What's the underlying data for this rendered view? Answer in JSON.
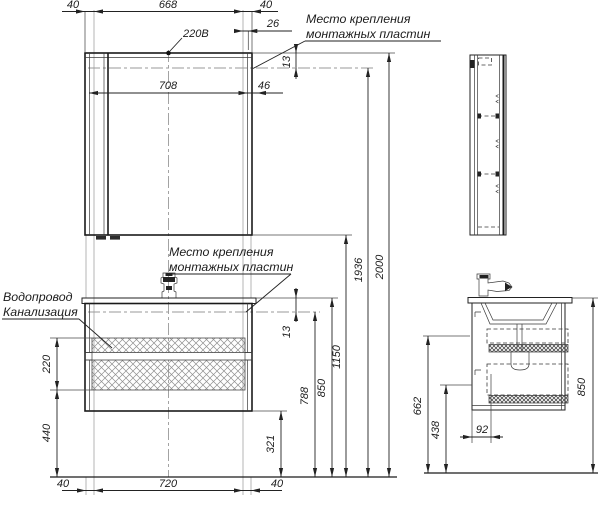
{
  "drawing": {
    "title_semantic": "bathroom-furniture-installation-drawing",
    "labels": {
      "power": "220В",
      "mount_top": [
        "Место крепления",
        "монтажных пластин"
      ],
      "mount_mid": [
        "Место крепления",
        "монтажных пластин"
      ],
      "water": "Водопровод",
      "sewer": "Канализация"
    },
    "dims": {
      "top_40_left": "40",
      "top_668": "668",
      "top_40_right": "40",
      "top_26": "26",
      "mirror_708": "708",
      "mirror_46": "46",
      "gap_13_top": "13",
      "gap_13_mid": "13",
      "h_220": "220",
      "h_440": "440",
      "h_321": "321",
      "h_788": "788",
      "h_850": "850",
      "h_1150": "1150",
      "h_1936": "1936",
      "h_2000": "2000",
      "bottom_40_left": "40",
      "bottom_720": "720",
      "bottom_40_right": "40",
      "side_662": "662",
      "side_438": "438",
      "side_92": "92",
      "side_850": "850"
    },
    "colors": {
      "line": "#1c1c1c",
      "auxiliary": "#b5b5b5",
      "hatch": "#8f8f8f",
      "background": "#ffffff"
    }
  }
}
